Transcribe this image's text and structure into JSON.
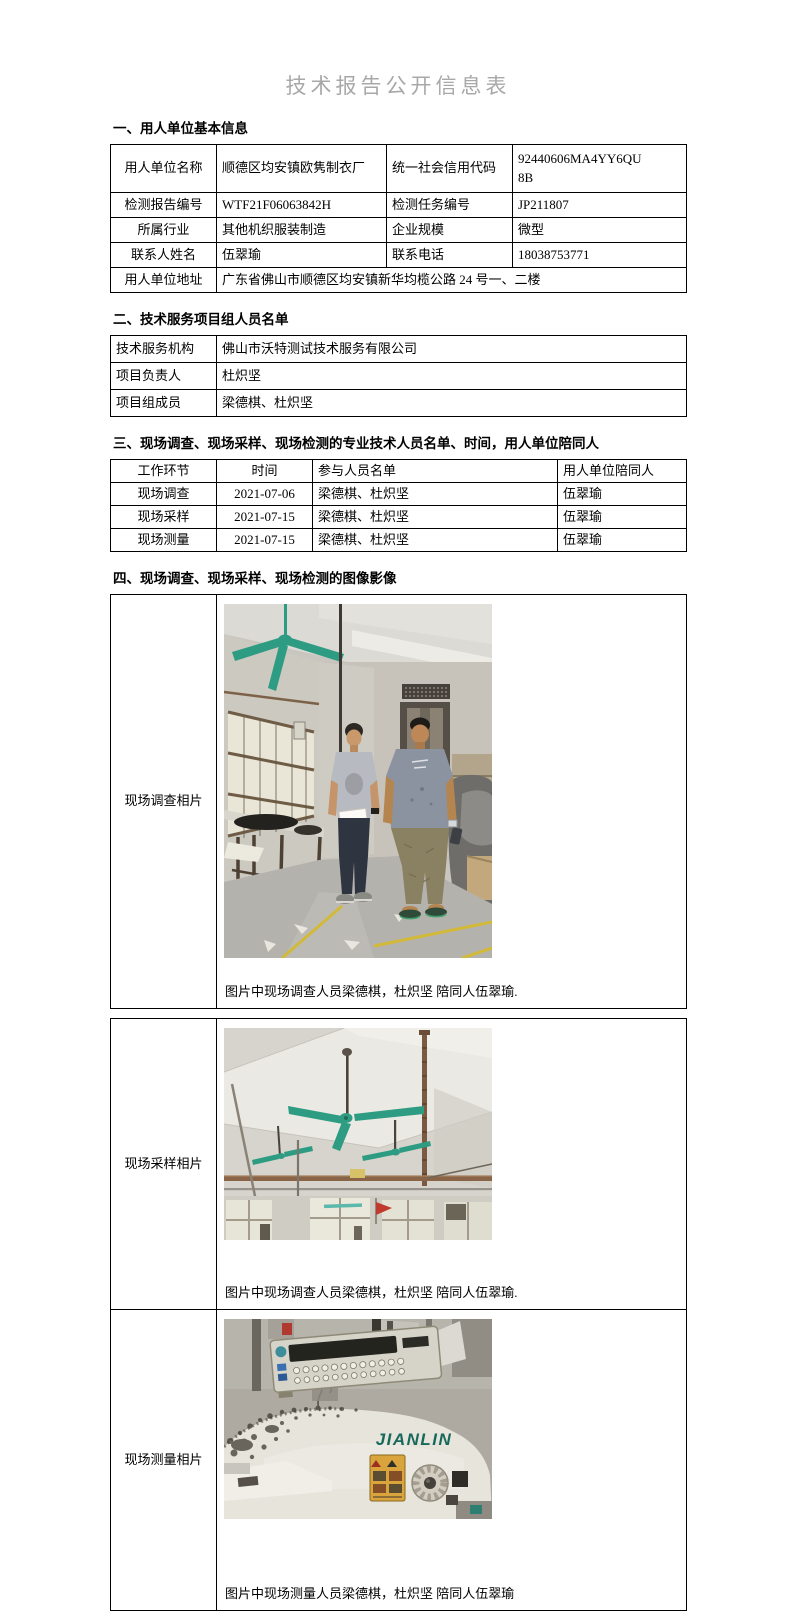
{
  "title": "技术报告公开信息表",
  "colors": {
    "title_text": "#a8a8a8",
    "border_black": "#000000",
    "fan_green": "#2e9c82",
    "brand_teal": "#17695c",
    "warning_yellow": "#d9a43c",
    "flag_red": "#c03b2d"
  },
  "section1": {
    "heading": "一、用人单位基本信息",
    "rows": [
      [
        "用人单位名称",
        "顺德区均安镇欧隽制衣厂",
        "统一社会信用代码",
        "92440606MA4YY6QU8B"
      ],
      [
        "检测报告编号",
        "WTF21F06063842H",
        "检测任务编号",
        "JP211807"
      ],
      [
        "所属行业",
        "其他机织服装制造",
        "企业规模",
        "微型"
      ],
      [
        "联系人姓名",
        "伍翠瑜",
        "联系电话",
        "18038753771"
      ],
      [
        "用人单位地址",
        "广东省佛山市顺德区均安镇新华均榄公路 24 号一、二楼"
      ]
    ]
  },
  "section2": {
    "heading": "二、技术服务项目组人员名单",
    "rows": [
      [
        "技术服务机构",
        "佛山市沃特测试技术服务有限公司"
      ],
      [
        "项目负责人",
        "杜炽坚"
      ],
      [
        "项目组成员",
        "梁德棋、杜炽坚"
      ]
    ]
  },
  "section3": {
    "heading": "三、现场调查、现场采样、现场检测的专业技术人员名单、时间，用人单位陪同人",
    "headers": [
      "工作环节",
      "时间",
      "参与人员名单",
      "用人单位陪同人"
    ],
    "rows": [
      [
        "现场调查",
        "2021-07-06",
        "梁德棋、杜炽坚",
        "伍翠瑜"
      ],
      [
        "现场采样",
        "2021-07-15",
        "梁德棋、杜炽坚",
        "伍翠瑜"
      ],
      [
        "现场测量",
        "2021-07-15",
        "梁德棋、杜炽坚",
        "伍翠瑜"
      ]
    ]
  },
  "section4": {
    "heading": "四、现场调查、现场采样、现场检测的图像影像",
    "photos": [
      {
        "label": "现场调查相片",
        "caption": "图片中现场调查人员梁德棋，杜炽坚 陪同人伍翠瑜."
      },
      {
        "label": "现场采样相片",
        "caption": "图片中现场调查人员梁德棋，杜炽坚 陪同人伍翠瑜."
      },
      {
        "label": "现场测量相片",
        "caption": "图片中现场测量人员梁德棋，杜炽坚 陪同人伍翠瑜",
        "machine_brand": "JIANLIN"
      }
    ]
  }
}
